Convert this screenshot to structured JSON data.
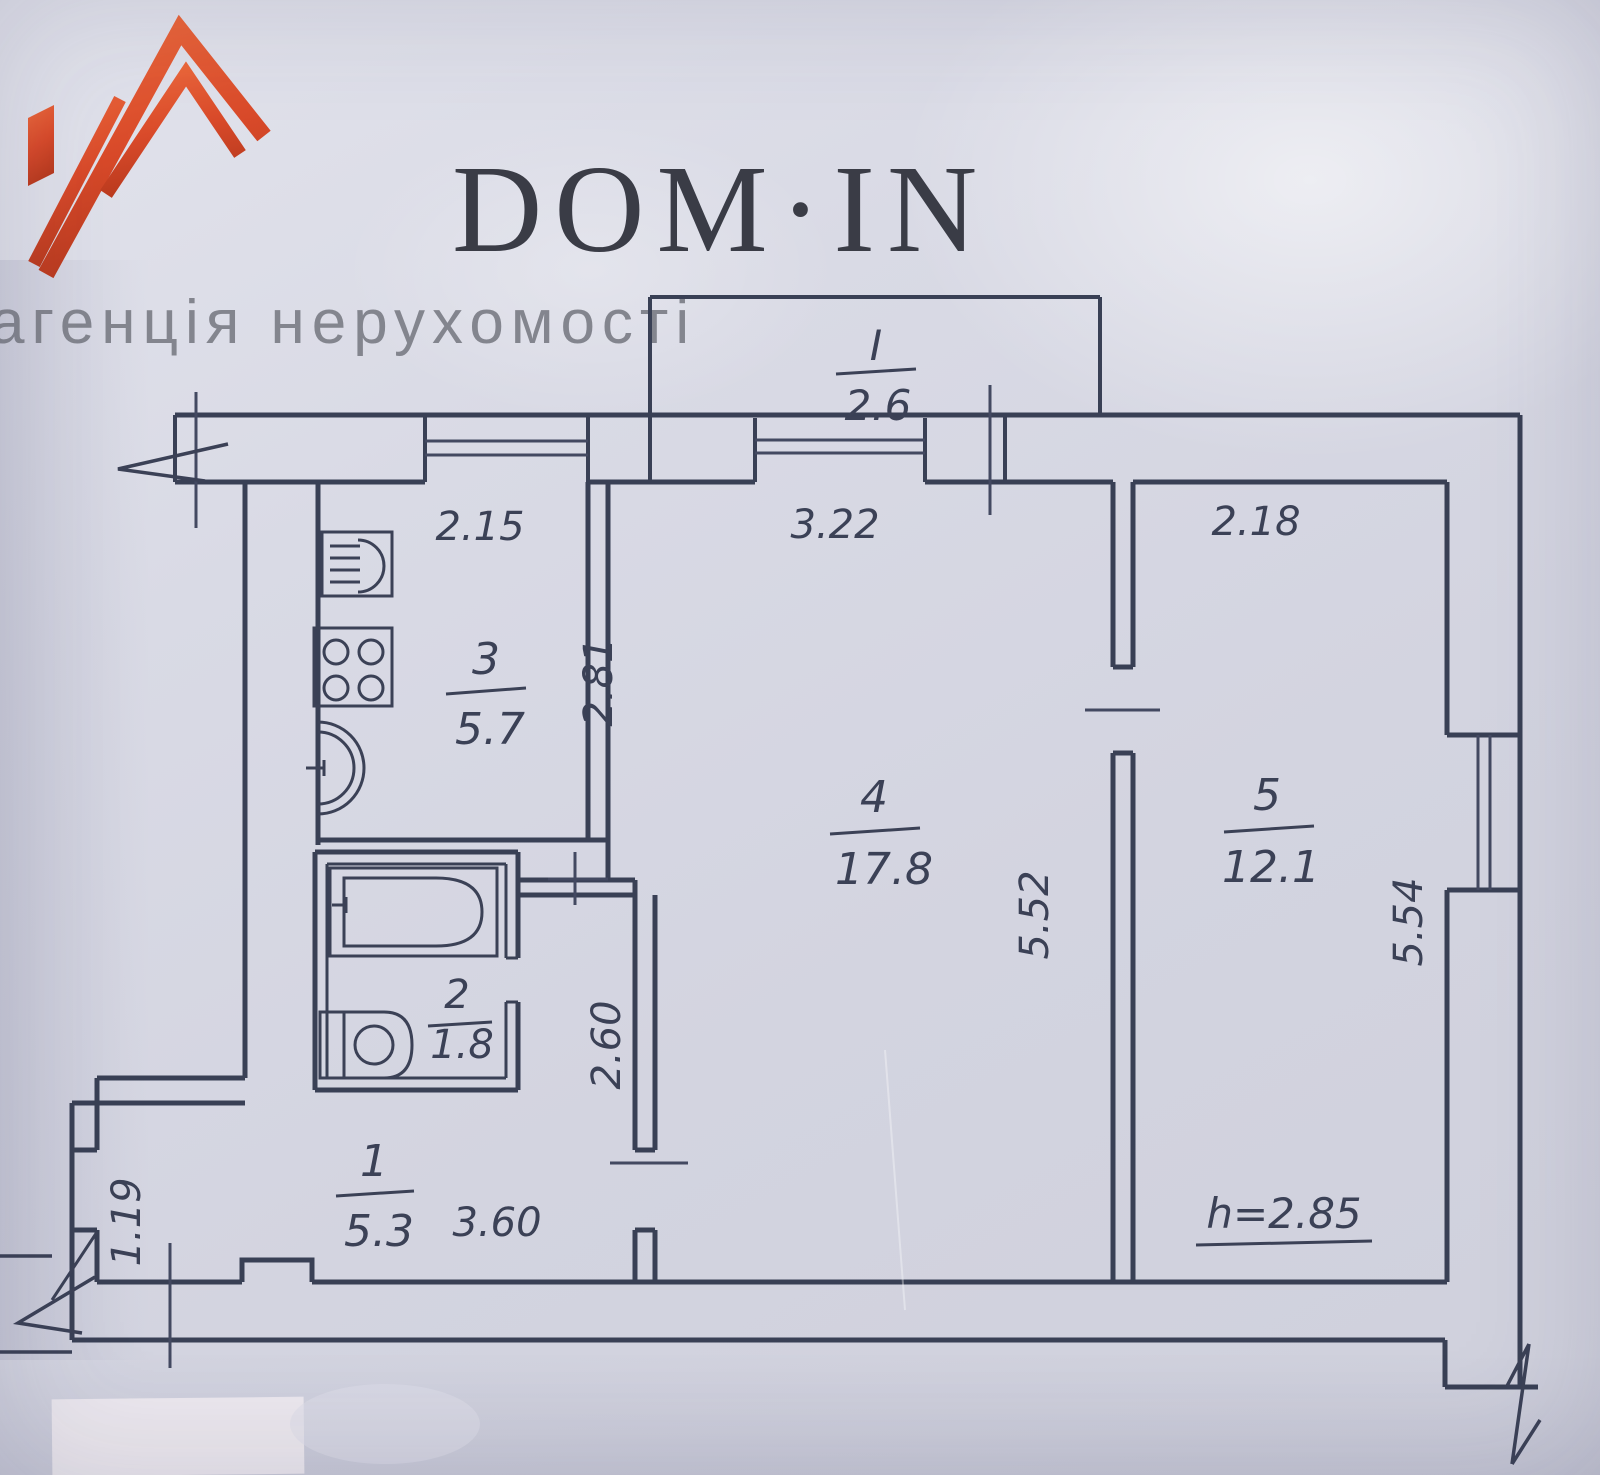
{
  "logo": {
    "brand": "DOM·IN",
    "tagline": "агенція нерухомості"
  },
  "plan": {
    "balcony": {
      "number": "I",
      "area": "2.6"
    },
    "hallway": {
      "number": "1",
      "area": "5.3",
      "width": "3.60",
      "niche_width": "1.19"
    },
    "bathroom": {
      "number": "2",
      "area": "1.8"
    },
    "kitchen": {
      "number": "3",
      "area": "5.7",
      "width": "2.15",
      "depth": "2.81"
    },
    "living_room": {
      "number": "4",
      "area": "17.8",
      "width": "3.22",
      "depth": "5.52"
    },
    "bedroom": {
      "number": "5",
      "area": "12.1",
      "width": "2.18",
      "depth": "5.54"
    },
    "corridor": {
      "depth": "2.60"
    },
    "ceiling_height": "h=2.85"
  },
  "colors": {
    "paper": "#d6d7e2",
    "line": "#394055",
    "logo_orange": "#d94a2a",
    "brand_text": "#3a3c46",
    "tagline_text": "#83858e"
  }
}
